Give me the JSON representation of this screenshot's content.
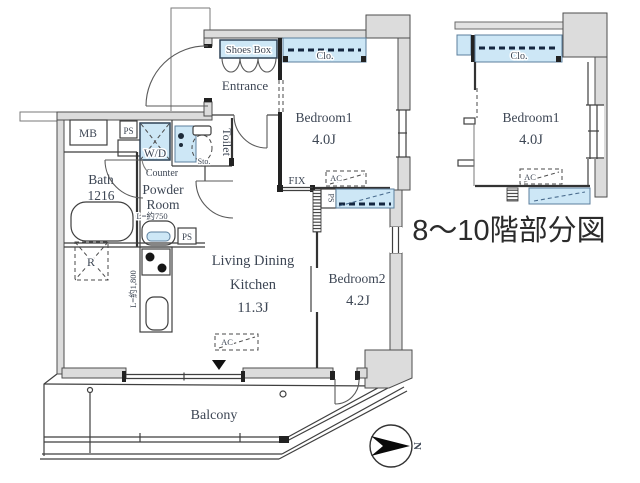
{
  "plan": {
    "caption": "8〜10階部分図",
    "labels": {
      "entrance": "Entrance",
      "shoes_box": "Shoes Box",
      "closet": "Clo.",
      "bedroom1": "Bedroom1",
      "bedroom1_size": "4.0J",
      "bedroom2": "Bedroom2",
      "bedroom2_size": "4.2J",
      "ldk_line1": "Living Dining",
      "ldk_line2": "Kitchen",
      "ldk_size": "11.3J",
      "bath": "Bath",
      "bath_size": "1216",
      "powder_line1": "Powder",
      "powder_line2": "Room",
      "counter": "Counter",
      "counter_length": "L=約750",
      "kitchen_length": "L=約1,800",
      "washer_dryer": "W/D",
      "toilet": "Toilet",
      "storage": "Sto.",
      "meter_box": "MB",
      "pipe_space": "PS",
      "fix_window": "FIX",
      "air_con": "AC",
      "refrigerator": "R",
      "balcony": "Balcony",
      "north": "N"
    },
    "partial": {
      "closet": "Clo.",
      "bedroom1": "Bedroom1",
      "bedroom1_size": "4.0J",
      "air_con": "AC"
    },
    "colors": {
      "wall_fill": "#dcdcdc",
      "closet_fill": "#cde7f6",
      "line": "#3f3f3f",
      "label": "#3d4654"
    }
  }
}
